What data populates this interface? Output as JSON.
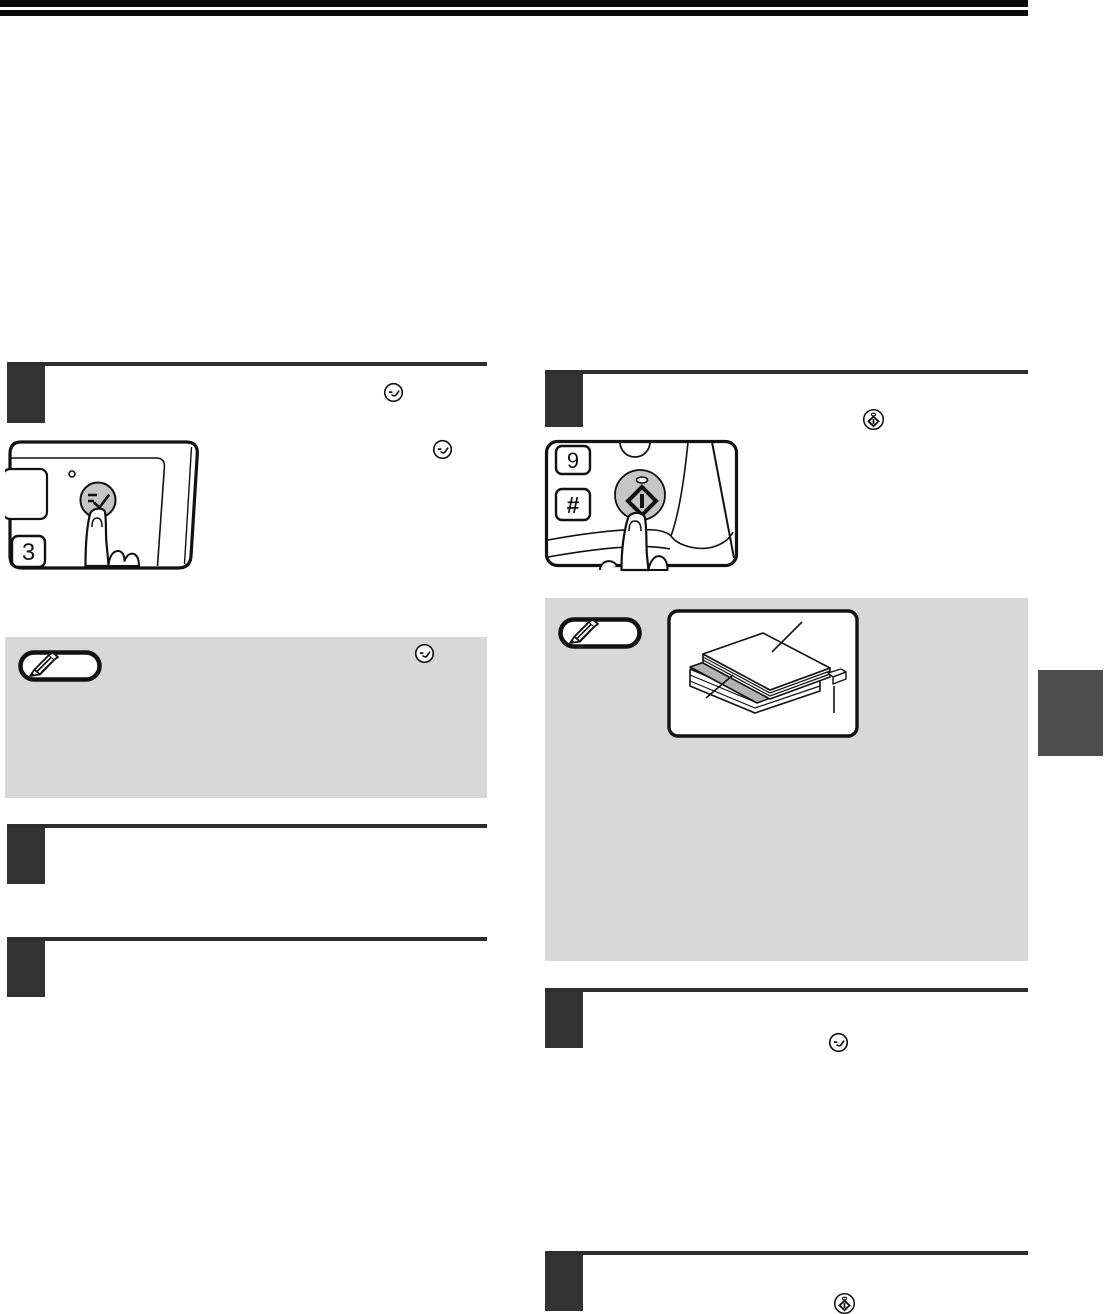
{
  "page": {
    "kind": "copier-manual-instruction-page",
    "visible_text_note": "page body text is blank in the scan; only key-cap labels are rendered",
    "colors": {
      "top_bars": "#0a0a0a",
      "heading_rule": "#2e2e2e",
      "step_box": "#333333",
      "note_box_bg": "#d8d8d8",
      "side_tab": "#4d4d4d",
      "key_button_fill": "#c6c6c6",
      "insert_sheet_gray": "#b3b3b3",
      "line_art": "#111111"
    }
  },
  "left_column": {
    "step_1": {
      "marker": "",
      "heading_icon": "check-key-icon",
      "body_icon": "check-key-icon"
    },
    "panel_illustration": {
      "description": "finger pressing round check key on control panel",
      "digit_key_label": "3",
      "pressed_key": "check-key",
      "has_led": true
    },
    "note": {
      "badge_icon": "pencil-icon",
      "body_icon": "check-key-icon"
    },
    "step_2": {
      "marker": ""
    },
    "step_3": {
      "marker": ""
    }
  },
  "right_column": {
    "step_1": {
      "marker": "",
      "heading_icon": "start-key-icon"
    },
    "panel_illustration": {
      "description": "finger pressing round start key on control panel",
      "digit_key_label": "9",
      "hash_key_label": "#",
      "pressed_key": "start-key",
      "has_led": true
    },
    "note": {
      "badge_icon": "pencil-icon",
      "illustration": "paper stack with gray insert sheet and tab, three leader lines"
    },
    "step_2": {
      "marker": "",
      "body_icon": "check-key-icon"
    },
    "step_3": {
      "marker": "",
      "body_icon": "start-key-icon"
    }
  }
}
